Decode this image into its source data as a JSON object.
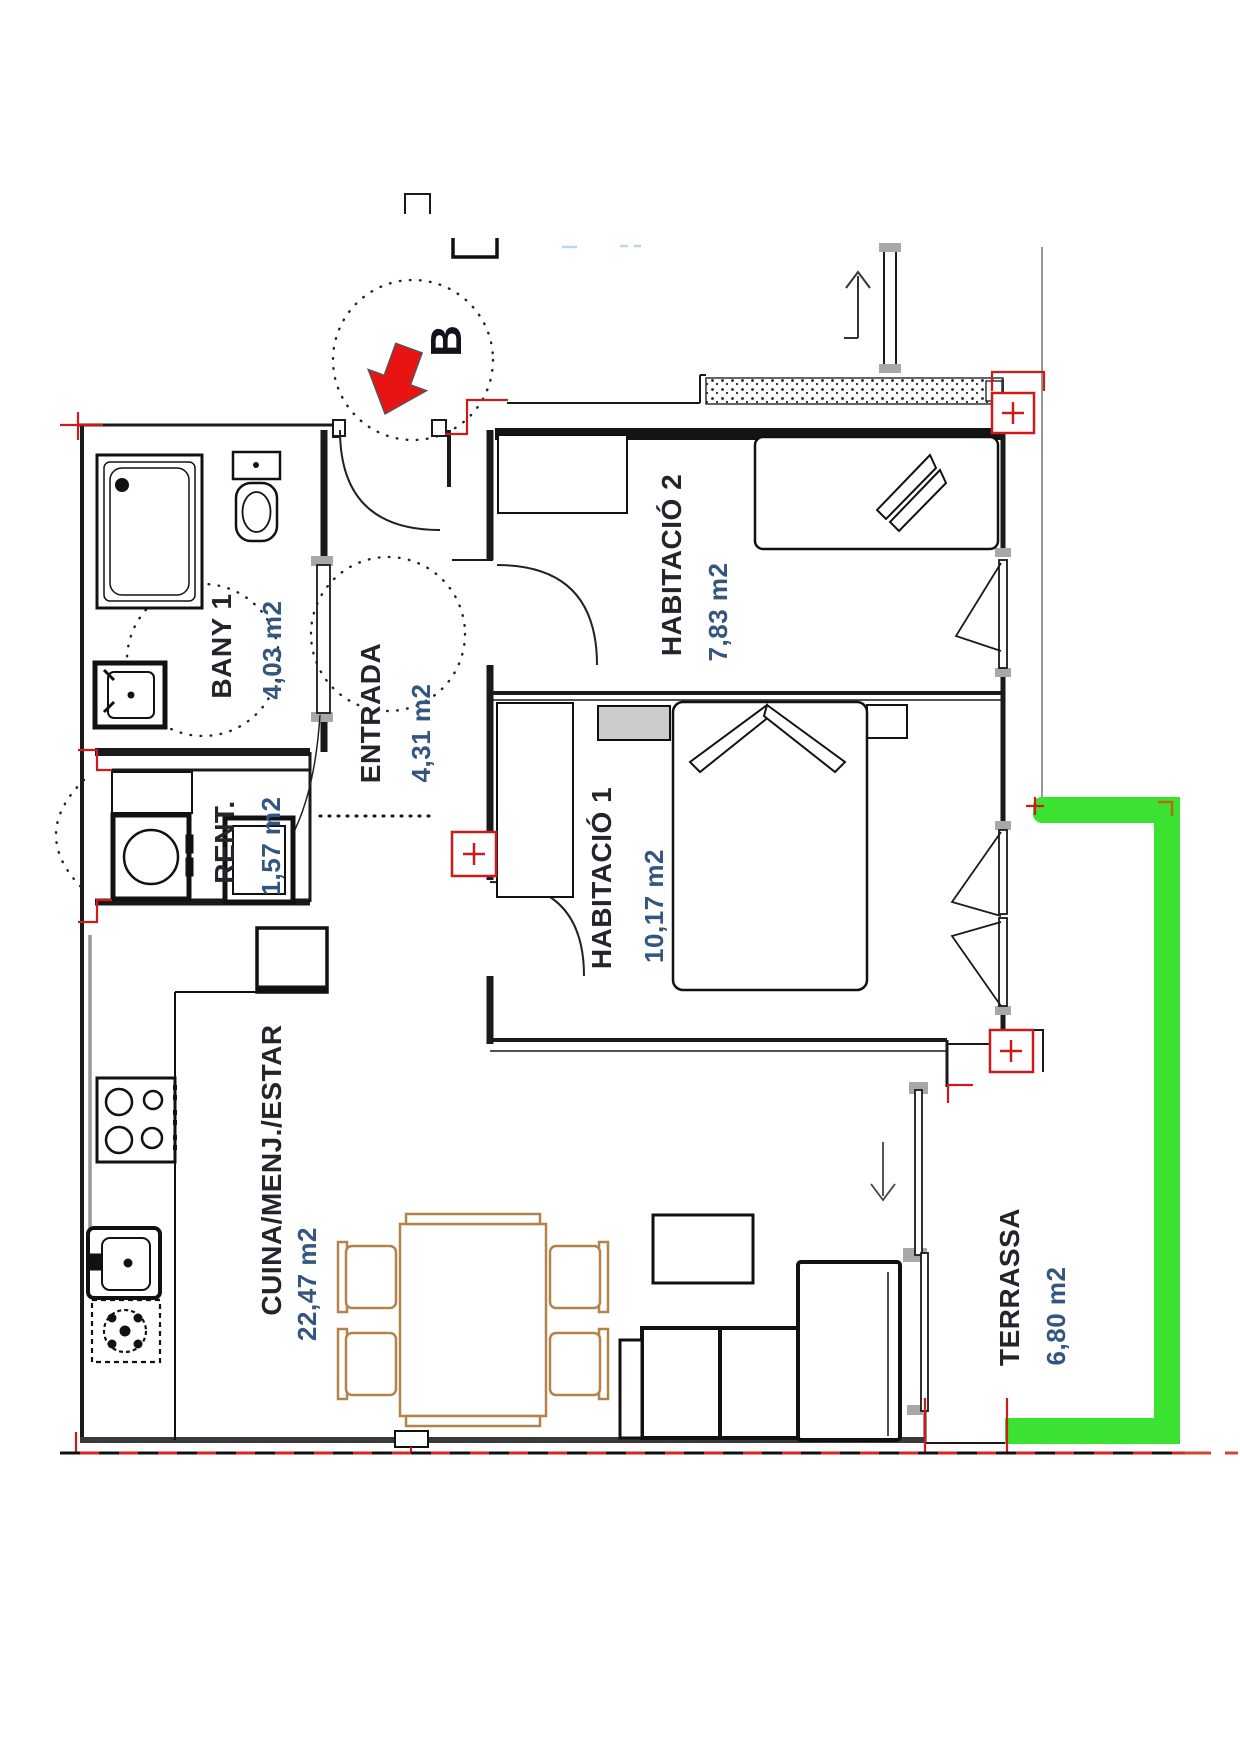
{
  "title": "Apartment floor plan",
  "unit_label": "B",
  "rooms": [
    {
      "name": "BANY 1",
      "area": "4,03 m2"
    },
    {
      "name": "RENT.",
      "area": "1,57 m2"
    },
    {
      "name": "ENTRADA",
      "area": "4,31 m2"
    },
    {
      "name": "HABITACIÓ 2",
      "area": "7,83 m2"
    },
    {
      "name": "HABITACIÓ 1",
      "area": "10,17 m2"
    },
    {
      "name": "CUINA/MENJ./ESTAR",
      "area": "22,47 m2"
    },
    {
      "name": "TERRASSA",
      "area": "6,80 m2"
    }
  ],
  "colors": {
    "wall_black": "#1a1a1a",
    "railing_green": "#3ce232",
    "marker_red": "#cd1a1a",
    "furniture_tan": "#b5824c",
    "label_dark": "#23252d",
    "area_blue": "#33557f",
    "boundary_dashed_red": "#d42626",
    "gray_fitting": "#a8a8a8"
  }
}
